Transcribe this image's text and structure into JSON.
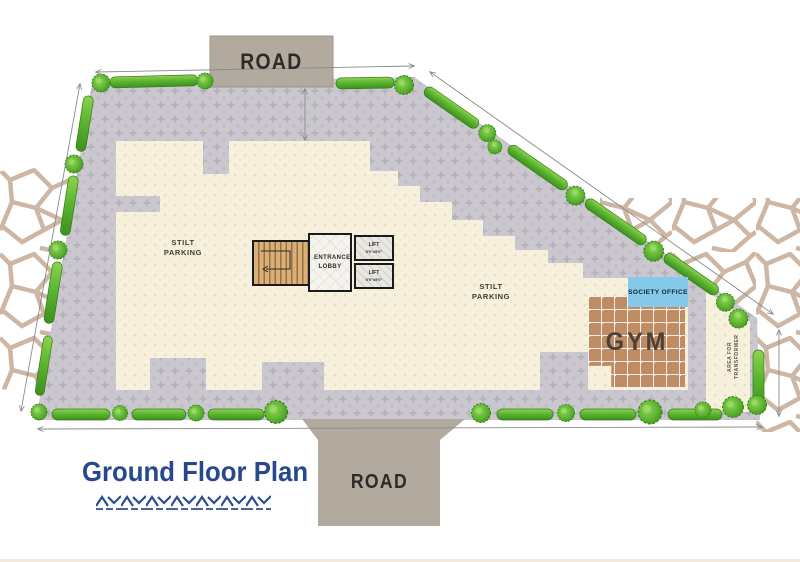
{
  "page": {
    "title": "Ground Floor Plan"
  },
  "roads": {
    "top_label": "ROAD",
    "bottom_label": "ROAD"
  },
  "parking": {
    "left_label": "STILT PARKING",
    "right_label": "STILT PARKING"
  },
  "core": {
    "entrance_lobby_label": "ENTRANCE LOBBY",
    "lift_top": {
      "label": "LIFT",
      "size": "5'0\"x5'0\""
    },
    "lift_bottom": {
      "label": "LIFT",
      "size": "5'0\"x5'0\""
    }
  },
  "amenities": {
    "society_office_label": "SOCIETY OFFICE",
    "gym_label": "GYM",
    "transformer_label": "AREA FOR TRANSFORMER"
  },
  "colors": {
    "title_navy": "#27498c",
    "hedge_green": "#5cb531",
    "pavement_gray": "#cac7ce",
    "parking_cream": "#f7f0dd",
    "road_tan": "#b2a99f",
    "gym_brown": "#bf8c64",
    "society_office_blue": "#84c8ea",
    "ornament_beige": "#cdb7a4"
  }
}
